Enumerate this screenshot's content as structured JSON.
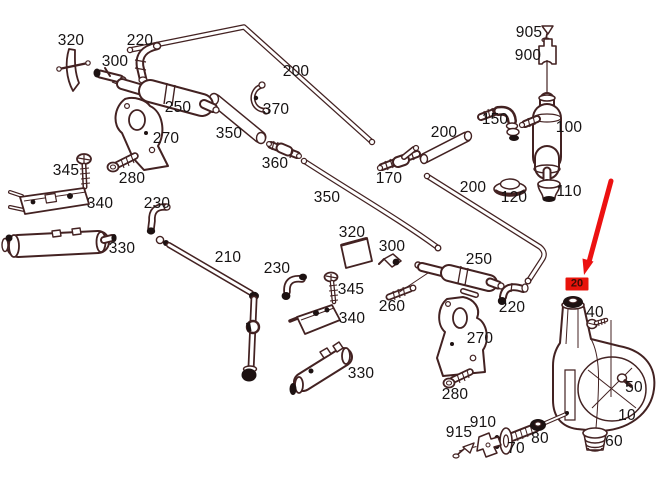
{
  "figure": {
    "type": "exploded-parts-diagram",
    "background": "#ffffff",
    "line_color": "#432222",
    "label_color": "#161313",
    "labels": [
      {
        "text": "320",
        "x": 71,
        "y": 41
      },
      {
        "text": "220",
        "x": 140,
        "y": 41
      },
      {
        "text": "300",
        "x": 115,
        "y": 62
      },
      {
        "text": "200",
        "x": 296,
        "y": 72
      },
      {
        "text": "250",
        "x": 178,
        "y": 108
      },
      {
        "text": "370",
        "x": 276,
        "y": 110
      },
      {
        "text": "350",
        "x": 229,
        "y": 134
      },
      {
        "text": "270",
        "x": 166,
        "y": 139
      },
      {
        "text": "360",
        "x": 275,
        "y": 164
      },
      {
        "text": "345",
        "x": 66,
        "y": 171
      },
      {
        "text": "280",
        "x": 132,
        "y": 179
      },
      {
        "text": "170",
        "x": 389,
        "y": 179
      },
      {
        "text": "200",
        "x": 473,
        "y": 188
      },
      {
        "text": "110",
        "x": 569,
        "y": 192
      },
      {
        "text": "120",
        "x": 514,
        "y": 198
      },
      {
        "text": "350",
        "x": 327,
        "y": 198
      },
      {
        "text": "340",
        "x": 100,
        "y": 204
      },
      {
        "text": "230",
        "x": 157,
        "y": 204
      },
      {
        "text": "100",
        "x": 569,
        "y": 128
      },
      {
        "text": "150",
        "x": 495,
        "y": 120
      },
      {
        "text": "200",
        "x": 444,
        "y": 133
      },
      {
        "text": "905",
        "x": 529,
        "y": 33
      },
      {
        "text": "900",
        "x": 528,
        "y": 56
      },
      {
        "text": "330",
        "x": 122,
        "y": 249
      },
      {
        "text": "210",
        "x": 228,
        "y": 258
      },
      {
        "text": "230",
        "x": 277,
        "y": 269
      },
      {
        "text": "320",
        "x": 352,
        "y": 233
      },
      {
        "text": "300",
        "x": 392,
        "y": 247
      },
      {
        "text": "250",
        "x": 479,
        "y": 260
      },
      {
        "text": "345",
        "x": 351,
        "y": 290
      },
      {
        "text": "260",
        "x": 392,
        "y": 307
      },
      {
        "text": "220",
        "x": 512,
        "y": 308
      },
      {
        "text": "340",
        "x": 352,
        "y": 319
      },
      {
        "text": "40",
        "x": 595,
        "y": 313
      },
      {
        "text": "330",
        "x": 361,
        "y": 374
      },
      {
        "text": "270",
        "x": 480,
        "y": 339
      },
      {
        "text": "50",
        "x": 634,
        "y": 388
      },
      {
        "text": "280",
        "x": 455,
        "y": 395
      },
      {
        "text": "10",
        "x": 627,
        "y": 416
      },
      {
        "text": "915",
        "x": 459,
        "y": 433
      },
      {
        "text": "910",
        "x": 483,
        "y": 423
      },
      {
        "text": "70",
        "x": 516,
        "y": 449
      },
      {
        "text": "80",
        "x": 540,
        "y": 439
      },
      {
        "text": "60",
        "x": 614,
        "y": 442
      }
    ],
    "highlight": {
      "label": "20",
      "box": {
        "x": 577,
        "y": 284,
        "fill": "#e8130b",
        "text_color": "#3b0d05"
      },
      "arrow": {
        "x1": 611,
        "y1": 181,
        "x2": 589,
        "y2": 262,
        "head": "584,275 593.5,261.5 582.5,258.5",
        "color": "#ec1111"
      }
    }
  }
}
